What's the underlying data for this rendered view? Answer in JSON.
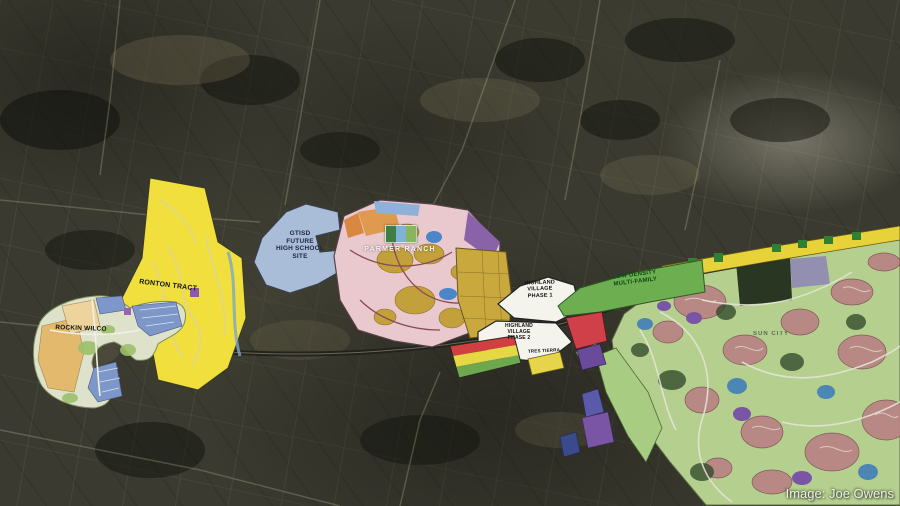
{
  "credit": "Image: Joe Owens",
  "map": {
    "type": "aerial-development-plan-map",
    "labels": [
      {
        "id": "ronton-tract",
        "text": "RONTON TRACT"
      },
      {
        "id": "rockin-wilco",
        "text": "ROCKIN WILCO"
      },
      {
        "id": "gtisd-site",
        "text": "GTISD\nFUTURE\nHIGH SCHOOL\nSITE"
      },
      {
        "id": "parmer-ranch",
        "text": "PARMER RANCH"
      },
      {
        "id": "highland-village-phase-1",
        "text": "HIGHLAND\nVILLAGE\nPHASE 1"
      },
      {
        "id": "highland-village-phase-2",
        "text": "HIGHLAND\nVILLAGE\nPHASE 2"
      },
      {
        "id": "tres-tierra",
        "text": "TRES TIERRA"
      },
      {
        "id": "low-density-multi-family",
        "text": "LOW DENSITY\nMULTI-FAMILY"
      },
      {
        "id": "sun-city",
        "text": "SUN CITY"
      }
    ],
    "colors": {
      "parcel_yellow": "#f0df3d",
      "school_site_blue": "#a9bdd9",
      "multifamily_green": "#6cae50",
      "parmer_pink": "#e9c9ce",
      "village_white": "#f4f3ec",
      "parcel_red": "#d04048",
      "masterplan_green": "#b5d08e",
      "commercial_strip_yellow": "#e8d23a"
    }
  }
}
